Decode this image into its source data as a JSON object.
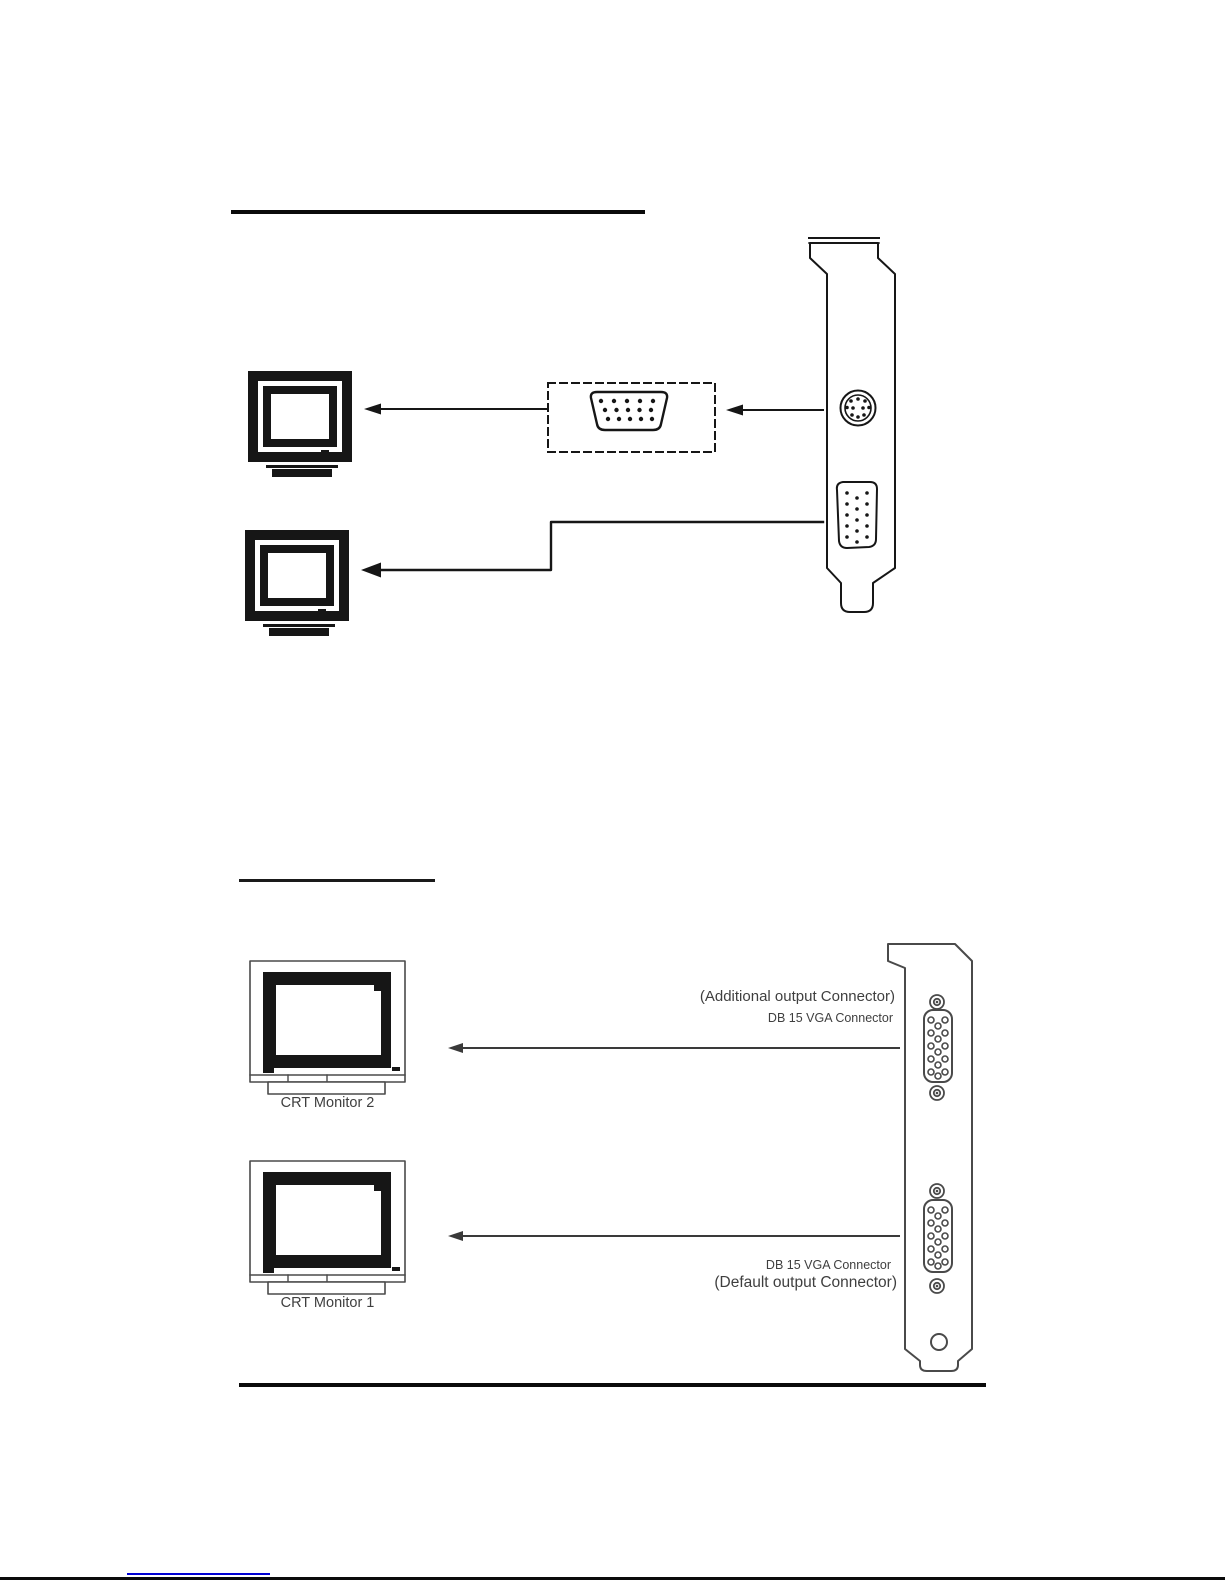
{
  "page": {
    "background": "#ffffff",
    "ink_color": "#161616",
    "scan_ink_color": "#4a4a4a",
    "label_color": "#3f3f3f",
    "link_color": "#0000d4"
  },
  "figure_top": {
    "icons": [
      "crt-monitor-icon",
      "crt-monitor-icon",
      "vga-adapter-connector-icon",
      "tv-out-port-icon",
      "vga-port-icon",
      "card-bracket-icon",
      "cable-arrow-icon"
    ]
  },
  "figure_bottom": {
    "icons": [
      "crt-monitor-icon",
      "crt-monitor-icon",
      "card-bracket-icon",
      "vga-port-icon",
      "vga-port-icon",
      "screw-post-icon",
      "mounting-hole-icon",
      "cable-arrow-icon"
    ],
    "monitor2_label": "CRT Monitor 2",
    "monitor1_label": "CRT Monitor 1",
    "additional_connector_note": "(Additional output Connector)",
    "additional_connector_type": "DB 15 VGA Connector",
    "default_connector_type": "DB 15 VGA Connector",
    "default_connector_note": "(Default output Connector)"
  }
}
